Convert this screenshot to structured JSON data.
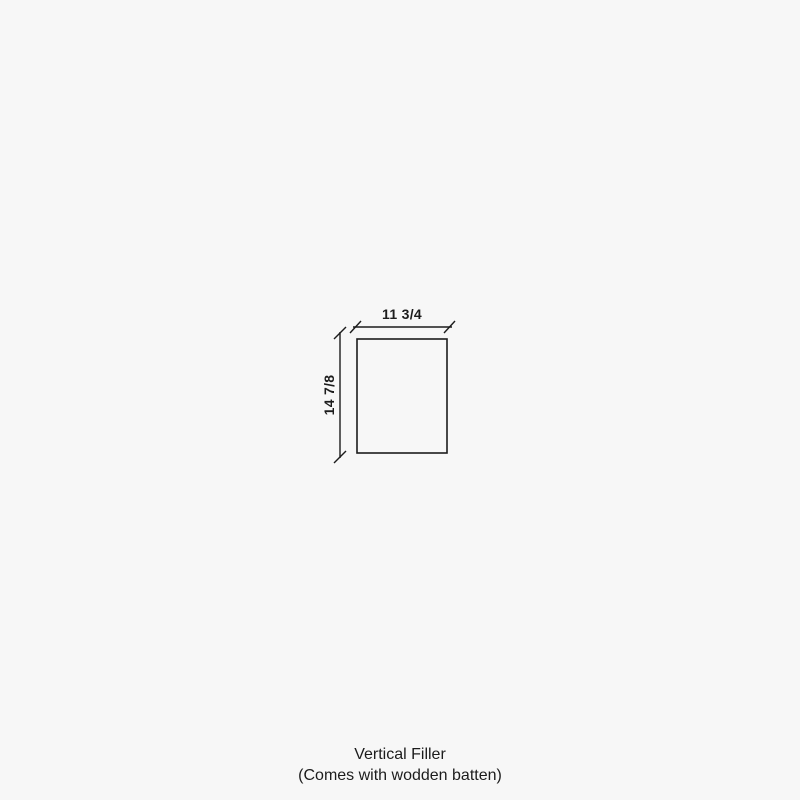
{
  "colors": {
    "background": "#f7f7f7",
    "line": "#1c1c1c",
    "text": "#1c1c1c"
  },
  "diagram": {
    "shape": "rectangle-outline",
    "width_label": "11 3/4",
    "height_label": "14 7/8"
  },
  "caption": {
    "line1": "Vertical Filler",
    "line2": "(Comes with wodden batten)"
  }
}
